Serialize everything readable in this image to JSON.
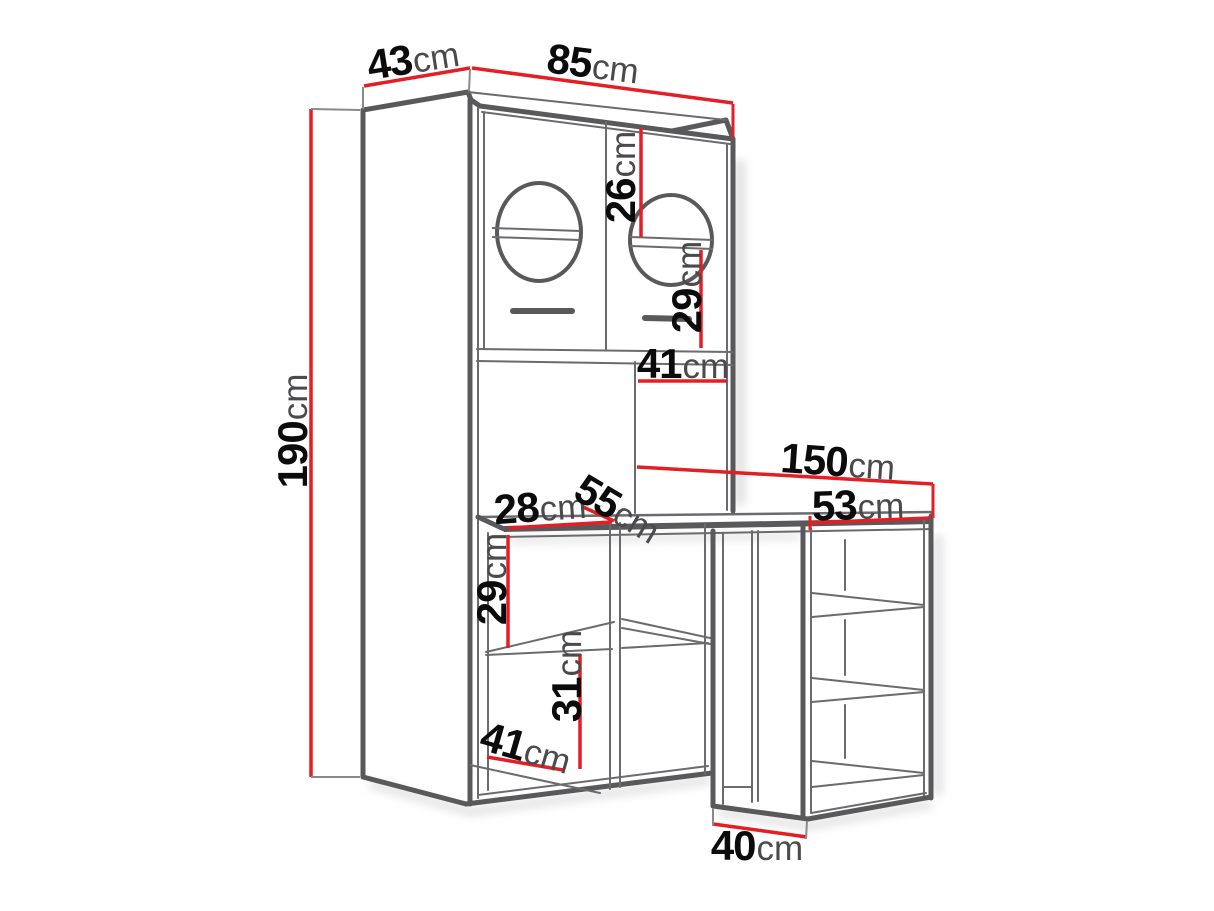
{
  "diagram": {
    "description": "Technical dimension line drawing of a wardrobe cabinet with washer portholes, open shelving and attached desk with side shelf unit",
    "unit": "cm",
    "colors": {
      "dimension_line": "#e31e24",
      "outline_dark": "#59595b",
      "outline_light": "#6b6b6e",
      "number_text": "#0b0b0b",
      "unit_text": "#4a4a4c",
      "background": "#ffffff"
    },
    "dimensions": [
      {
        "name": "top-depth",
        "value": "43",
        "unit": "cm"
      },
      {
        "name": "top-width",
        "value": "85",
        "unit": "cm"
      },
      {
        "name": "door-upper-height",
        "value": "26",
        "unit": "cm"
      },
      {
        "name": "door-lower-height",
        "value": "29",
        "unit": "cm"
      },
      {
        "name": "niche-width",
        "value": "41",
        "unit": "cm"
      },
      {
        "name": "total-height",
        "value": "190",
        "unit": "cm"
      },
      {
        "name": "desk-length",
        "value": "150",
        "unit": "cm"
      },
      {
        "name": "side-unit-width",
        "value": "53",
        "unit": "cm"
      },
      {
        "name": "left-cubby-width",
        "value": "28",
        "unit": "cm"
      },
      {
        "name": "desk-depth",
        "value": "55",
        "unit": "cm"
      },
      {
        "name": "upper-cubby-height",
        "value": "29",
        "unit": "cm"
      },
      {
        "name": "lower-cubby-height",
        "value": "31",
        "unit": "cm"
      },
      {
        "name": "interior-depth",
        "value": "41",
        "unit": "cm"
      },
      {
        "name": "base-depth",
        "value": "40",
        "unit": "cm"
      }
    ]
  }
}
